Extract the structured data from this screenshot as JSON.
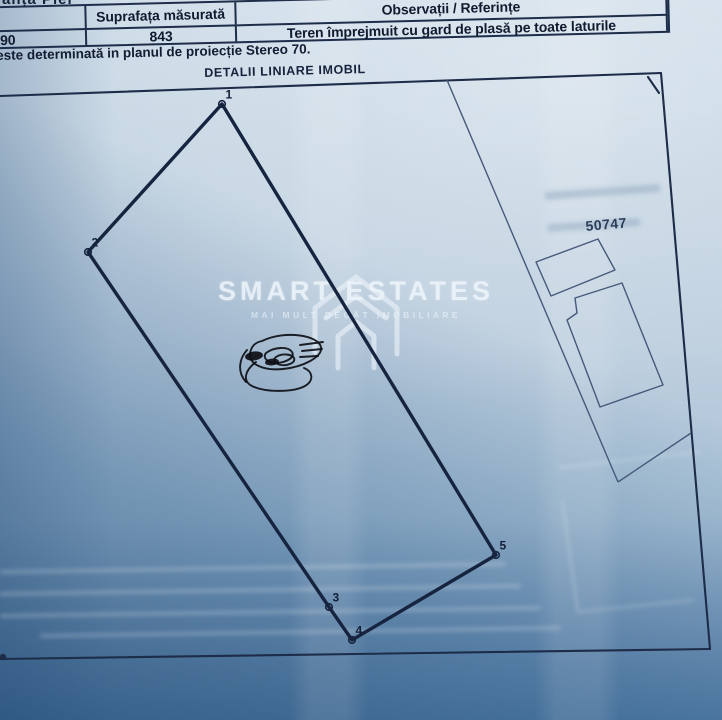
{
  "top_fragment": "anța Pier",
  "table": {
    "headers": [
      "lastral",
      "Suprafața măsurată",
      "Observații / Referințe"
    ],
    "row": [
      "90",
      "843",
      "Teren împrejmuit cu gard de plasă pe toate laturile"
    ]
  },
  "note": "este determinată in planul de proiecție Stereo 70.",
  "plan": {
    "title": "DETALII LINIARE IMOBIL",
    "neighbor_parcel_number": "50747",
    "vertices": [
      {
        "label": "1",
        "x": 222,
        "y": 104
      },
      {
        "label": "2",
        "x": 88,
        "y": 252
      },
      {
        "label": "3",
        "x": 329,
        "y": 607
      },
      {
        "label": "4",
        "x": 352,
        "y": 640
      },
      {
        "label": "5",
        "x": 496,
        "y": 555
      }
    ]
  },
  "watermark": {
    "brand": "SMART ESTATES",
    "tagline": "MAI MULT DECÂT IMOBILIARE"
  },
  "colors": {
    "paper": "#bed0df",
    "ink": "#16243f",
    "shadow_blue": "#5d82a8"
  }
}
